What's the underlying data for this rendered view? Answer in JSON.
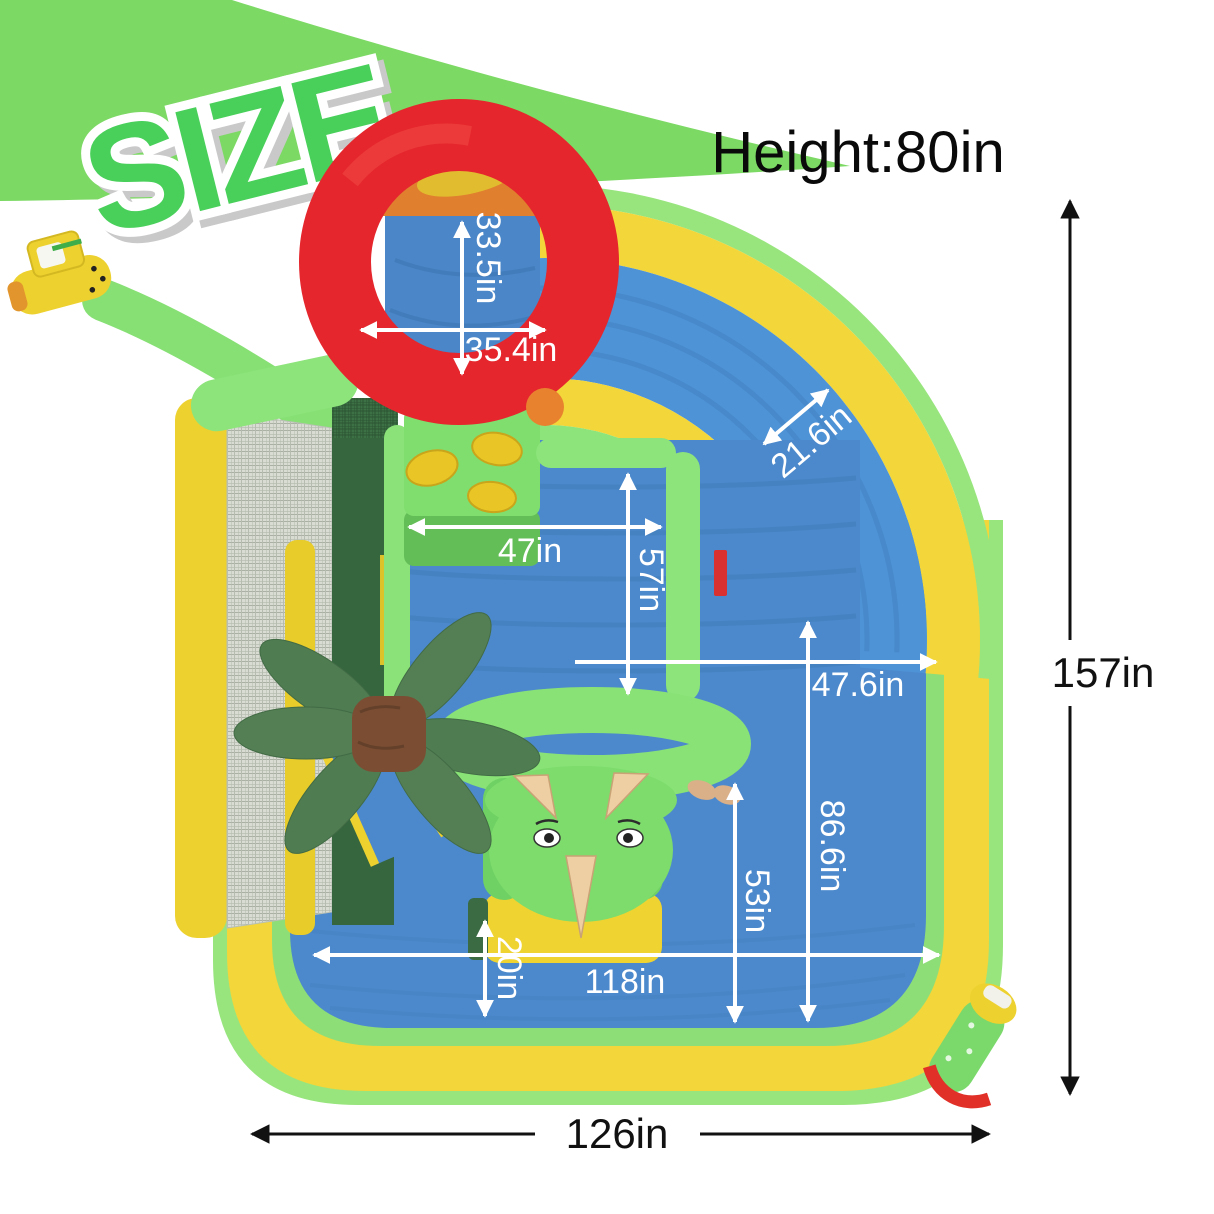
{
  "badge": {
    "label": "SIZE"
  },
  "header": {
    "height_label": "Height:80in"
  },
  "dimensions": {
    "ring_opening_height": "33.5in",
    "ring_opening_width": "35.4in",
    "slide_lane_width": "21.6in",
    "bounce_area_width": "47in",
    "bounce_area_depth": "57in",
    "pool_side_width": "47.6in",
    "pool_side_depth": "86.6in",
    "hoop_to_pool_depth": "53in",
    "pool_inner_width": "118in",
    "pool_rim_depth": "20in",
    "overall_width": "126in",
    "overall_depth": "157in"
  },
  "colors": {
    "swoosh_green": "#7CD964",
    "badge_green": "#48D05A",
    "inflatable_green": "#8CE47A",
    "yellow": "#F2D63A",
    "blue": "#4C89CC",
    "ring_red": "#E5262C",
    "palm_green": "#4F7C51",
    "trunk_brown": "#7B4E33",
    "dim_text_white": "#FFFFFF",
    "dim_text_black": "#111111"
  }
}
